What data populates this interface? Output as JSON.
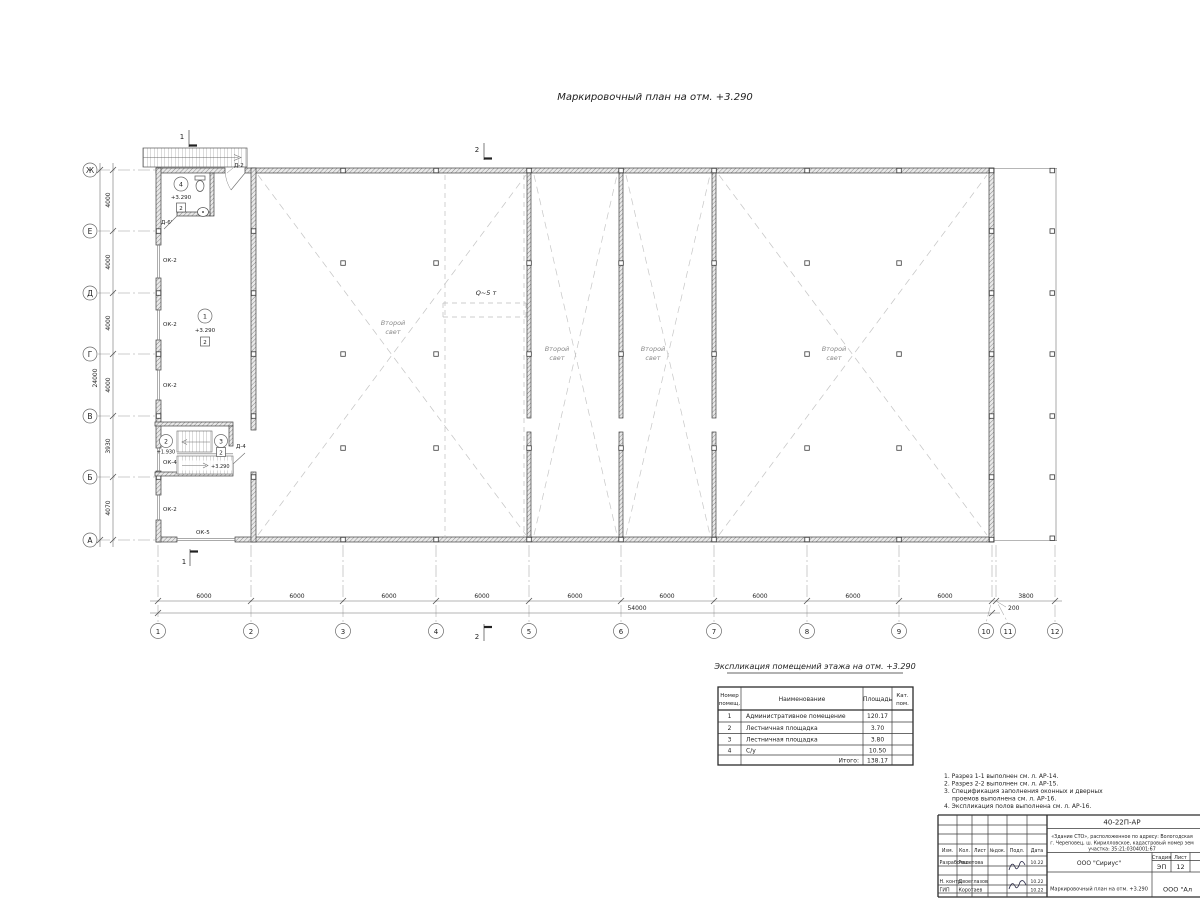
{
  "title": "Маркировочный план на отм. +3.290",
  "colors": {
    "line": "#3f3f3f",
    "hatch": "#8a8a8a",
    "dashed": "#c6c6c6",
    "accent": "#1f1f1f"
  },
  "plan": {
    "section1": "1",
    "section2": "2",
    "crane_label": "Q~5 т",
    "void_l1": "Второй",
    "void_l2": "свет",
    "rooms": {
      "r1": {
        "num": "1",
        "elev": "+3.290",
        "floor": "2"
      },
      "r2": {
        "num": "2",
        "elev": "+1.930"
      },
      "r3": {
        "num": "3",
        "elev": "+3.290",
        "floor": "2"
      },
      "r4": {
        "num": "4",
        "elev": "+3.290",
        "floor": "2"
      }
    },
    "openings": {
      "d2": "Д-2",
      "d4": "Д-4",
      "d6": "Д-6'",
      "ok2": "ОК-2",
      "ok4": "ОК-4",
      "ok5": "ОК-5"
    }
  },
  "axes": {
    "rows": [
      "Ж",
      "Е",
      "Д",
      "Г",
      "В",
      "Б",
      "А"
    ],
    "cols": [
      "1",
      "2",
      "3",
      "4",
      "5",
      "6",
      "7",
      "8",
      "9",
      "10",
      "11",
      "12"
    ],
    "row_dims": [
      "4000",
      "4000",
      "4000",
      "4000",
      "3930",
      "4070"
    ],
    "row_total": "24000",
    "col_dims": [
      "6000",
      "6000",
      "6000",
      "6000",
      "6000",
      "6000",
      "6000",
      "6000",
      "6000",
      "200",
      "3800"
    ],
    "col_total": "54000"
  },
  "legend_table": {
    "title": "Экспликация помещений этажа на отм. +3.290",
    "headers": {
      "num_l1": "Номер",
      "num_l2": "помещ.",
      "name": "Наименование",
      "area": "Площадь",
      "cat_l1": "Кат.",
      "cat_l2": "пом."
    },
    "rows": [
      {
        "num": "1",
        "name": "Административное помещение",
        "area": "120.17"
      },
      {
        "num": "2",
        "name": "Лестничная площадка",
        "area": "3.70"
      },
      {
        "num": "3",
        "name": "Лестничная площадка",
        "area": "3.80"
      },
      {
        "num": "4",
        "name": "С/у",
        "area": "10.50"
      }
    ],
    "total_label": "Итого:",
    "total_value": "138.17"
  },
  "notes": [
    "1. Разрез 1-1 выполнен см. л. АР-14.",
    "2. Разрез 2-2 выполнен см. л. АР-15.",
    "3. Спецификация заполнения оконных и дверных",
    "проемов выполнена см. л. АР-16.",
    "4. Экспликация полов выполнена см. л. АР-16."
  ],
  "stamp": {
    "doc_number": "40-22П-АР",
    "project_l1": "«Здание СТО», расположенное по адресу: Вологодская",
    "project_l2": "г. Череповец, ш. Кирилловское, кадастровый номер зем",
    "project_l3": "участка: 35:21:0304001:67",
    "header_cols": [
      "Изм.",
      "Кол.",
      "Лист",
      "№док.",
      "Подл.",
      "Дата"
    ],
    "rows": [
      {
        "role": "Разработал",
        "name": "Решетова",
        "date": "10.22"
      },
      {
        "role": "Н. контр.",
        "name": "Двоеглазов",
        "date": "10.22"
      },
      {
        "role": "ГИП",
        "name": "Коротаев",
        "date": "10.22"
      }
    ],
    "org": "ООО \"Сириус\"",
    "stage_label": "Стадия",
    "sheet_label": "Лист",
    "stage": "ЭП",
    "sheet": "12",
    "drawing_title": "Маркировочный план на отм. +3.290",
    "org2": "ООО \"Ал"
  }
}
